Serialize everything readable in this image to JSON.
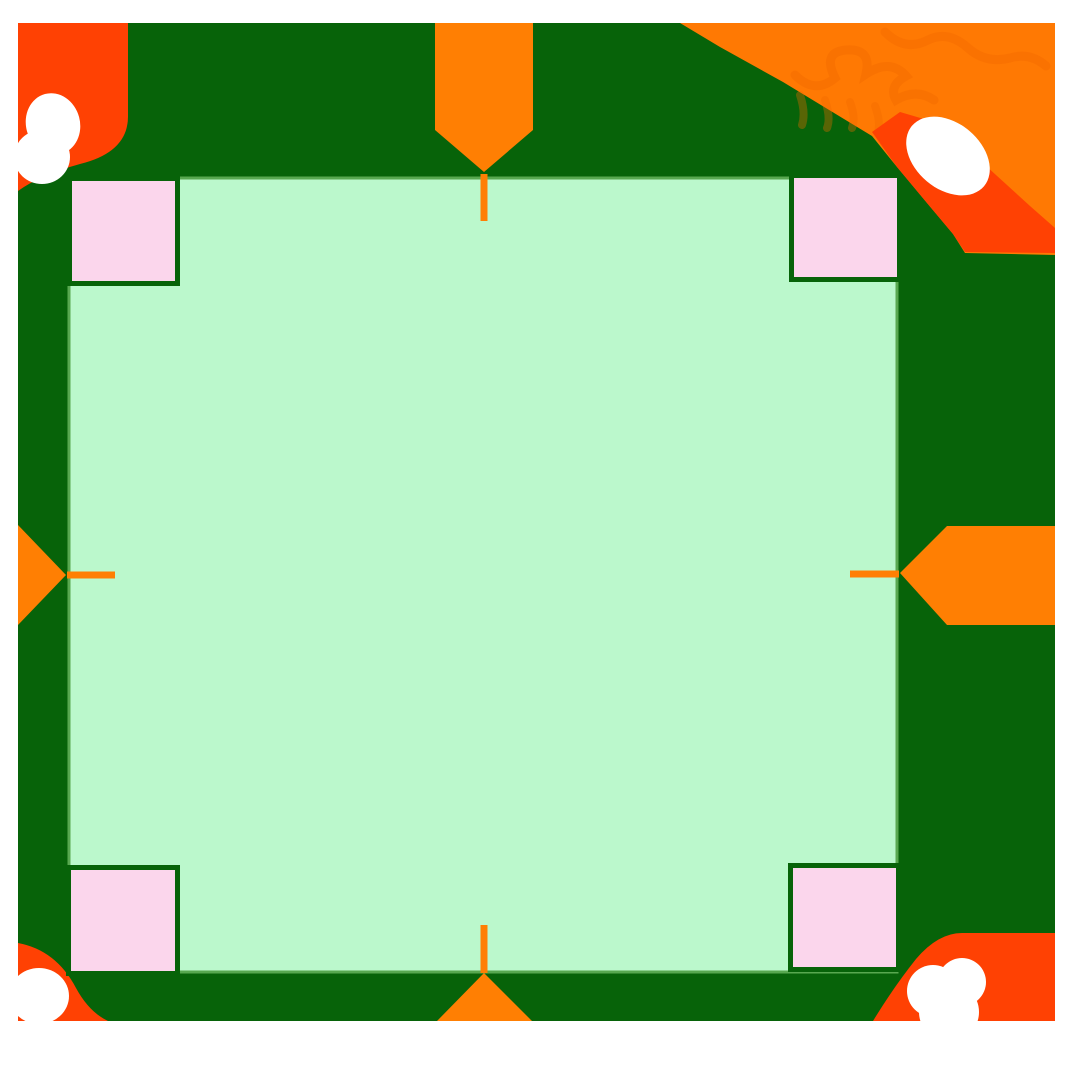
{
  "page": {
    "width": 1080,
    "height": 1080,
    "background": "#ffffff"
  },
  "colors": {
    "page_background": "#ffffff",
    "board_green": "#076309",
    "square_fill": "#bbf8cc",
    "square_stroke": "#58a850",
    "corner_marker_fill": "#fbd6ec",
    "corner_marker_border": "#076309",
    "accent_orange": "#ff7f03",
    "decoration_orange_bright": "#ff7903",
    "decoration_orange_texture": "#f26a00",
    "decoration_orange_red": "#ff4103",
    "decoration_white": "#ffffff"
  },
  "figure": {
    "board": {
      "x": 18,
      "y": 23,
      "w": 1037,
      "h": 998,
      "fill": "#076309"
    },
    "square": {
      "x": 69,
      "y": 178,
      "w": 828,
      "h": 794,
      "fill": "#bbf8cc",
      "stroke": "#58a850",
      "stroke_width": 3
    },
    "decorations": [
      {
        "type": "path",
        "name": "corner-splash-top-left",
        "d": "M18,23 H128 V115 Q129,152 80,164 Q40,175 18,191 Z",
        "fill": "#ff4103"
      },
      {
        "type": "ellipse",
        "name": "paint-blob-top-left-upper",
        "cx": 53,
        "cy": 124,
        "rx": 27,
        "ry": 31,
        "rotate": -15,
        "fill": "#ffffff"
      },
      {
        "type": "ellipse",
        "name": "paint-blob-top-left-lower",
        "cx": 42,
        "cy": 157,
        "rx": 28,
        "ry": 27,
        "rotate": 0,
        "fill": "#ffffff"
      },
      {
        "type": "polygon",
        "name": "corner-splash-top-right",
        "points": [
          [
            680,
            23
          ],
          [
            1055,
            23
          ],
          [
            1055,
            255
          ],
          [
            965,
            253
          ],
          [
            953,
            234
          ],
          [
            927,
            203
          ],
          [
            897,
            167
          ],
          [
            872,
            136
          ],
          [
            783,
            82
          ],
          [
            720,
            47
          ]
        ],
        "fill": "#ff7903"
      },
      {
        "type": "path",
        "name": "texture-squiggle-top-right-1",
        "d": "M795,75 Q815,95 835,78 Q822,52 846,50 Q872,48 866,74 Q890,58 906,76 Q888,86 896,100 Q916,88 934,100",
        "stroke": "#f26a00",
        "stroke_width": 9,
        "fill": "none",
        "opacity": 0.45
      },
      {
        "type": "path",
        "name": "texture-squiggle-top-right-2",
        "d": "M885,32 Q905,52 928,40 Q948,30 968,48 Q986,64 1010,58 Q1030,52 1046,66",
        "stroke": "#f26a00",
        "stroke_width": 9,
        "fill": "none",
        "opacity": 0.4
      },
      {
        "type": "path",
        "name": "texture-fringe-top-right",
        "d": "M800,95 q6,18 2,30 M825,100 q6,18 2,28 M850,102 q6,16 2,26 M875,106 q6,16 3,26",
        "stroke": "#f26a00",
        "stroke_width": 8,
        "fill": "none",
        "opacity": 0.35
      },
      {
        "type": "polygon",
        "name": "corner-splash-top-right-red",
        "points": [
          [
            872,
            132
          ],
          [
            900,
            112
          ],
          [
            934,
            122
          ],
          [
            985,
            165
          ],
          [
            1030,
            206
          ],
          [
            1055,
            228
          ],
          [
            1055,
            253
          ],
          [
            965,
            252
          ],
          [
            953,
            234
          ],
          [
            927,
            203
          ],
          [
            897,
            167
          ]
        ],
        "fill": "#ff4103"
      },
      {
        "type": "ellipse",
        "name": "paint-blob-top-right",
        "cx": 948,
        "cy": 156,
        "rx": 47,
        "ry": 33,
        "rotate": 40,
        "fill": "#ffffff"
      },
      {
        "type": "path",
        "name": "corner-splash-bottom-left",
        "d": "M18,943 Q56,950 76,988 Q89,1012 108,1021 H18 Z",
        "fill": "#ff4103"
      },
      {
        "type": "ellipse",
        "name": "paint-blob-bottom-left",
        "cx": 39,
        "cy": 996,
        "rx": 30,
        "ry": 28,
        "rotate": 0,
        "fill": "#ffffff"
      },
      {
        "type": "path",
        "name": "corner-splash-bottom-right",
        "d": "M873,1021 Q893,988 916,959 Q938,933 962,933 H1055 V1021 Z",
        "fill": "#ff4103"
      },
      {
        "type": "circle",
        "name": "paint-blob-bottom-right-1",
        "cx": 933,
        "cy": 991,
        "r": 26,
        "fill": "#ffffff"
      },
      {
        "type": "circle",
        "name": "paint-blob-bottom-right-2",
        "cx": 962,
        "cy": 982,
        "r": 24,
        "fill": "#ffffff"
      },
      {
        "type": "circle",
        "name": "paint-blob-bottom-right-3",
        "cx": 949,
        "cy": 1012,
        "r": 30,
        "fill": "#ffffff"
      }
    ],
    "corner_markers": [
      {
        "position": "top-left",
        "outer": {
          "x": 67,
          "y": 176,
          "w": 113,
          "h": 110
        },
        "inner": {
          "x": 72,
          "y": 181,
          "w": 103,
          "h": 100
        }
      },
      {
        "position": "top-right",
        "outer": {
          "x": 789,
          "y": 173,
          "w": 113,
          "h": 109
        },
        "inner": {
          "x": 794,
          "y": 178,
          "w": 103,
          "h": 99
        }
      },
      {
        "position": "bottom-left",
        "outer": {
          "x": 66,
          "y": 865,
          "w": 114,
          "h": 111
        },
        "inner": {
          "x": 71,
          "y": 870,
          "w": 104,
          "h": 101
        }
      },
      {
        "position": "bottom-right",
        "outer": {
          "x": 788,
          "y": 863,
          "w": 113,
          "h": 109
        },
        "inner": {
          "x": 793,
          "y": 868,
          "w": 103,
          "h": 99
        }
      }
    ],
    "side_arrows": [
      {
        "side": "top",
        "points": [
          [
            435,
            23
          ],
          [
            533,
            23
          ],
          [
            533,
            130
          ],
          [
            484,
            172
          ],
          [
            435,
            130
          ]
        ]
      },
      {
        "side": "right",
        "points": [
          [
            1055,
            526
          ],
          [
            947,
            526
          ],
          [
            900,
            573
          ],
          [
            947,
            625
          ],
          [
            1055,
            625
          ]
        ]
      },
      {
        "side": "bottom",
        "points": [
          [
            437,
            1021
          ],
          [
            484,
            973
          ],
          [
            532,
            1021
          ]
        ]
      },
      {
        "side": "left",
        "points": [
          [
            18,
            525
          ],
          [
            66,
            575
          ],
          [
            18,
            625
          ]
        ]
      }
    ],
    "side_ticks": [
      {
        "side": "top",
        "x1": 484,
        "y1": 174,
        "x2": 484,
        "y2": 221
      },
      {
        "side": "right",
        "x1": 899,
        "y1": 574,
        "x2": 850,
        "y2": 574
      },
      {
        "side": "bottom",
        "x1": 484,
        "y1": 973,
        "x2": 484,
        "y2": 925
      },
      {
        "side": "left",
        "x1": 67,
        "y1": 575,
        "x2": 115,
        "y2": 575
      }
    ],
    "tick_stroke_width": 7
  }
}
